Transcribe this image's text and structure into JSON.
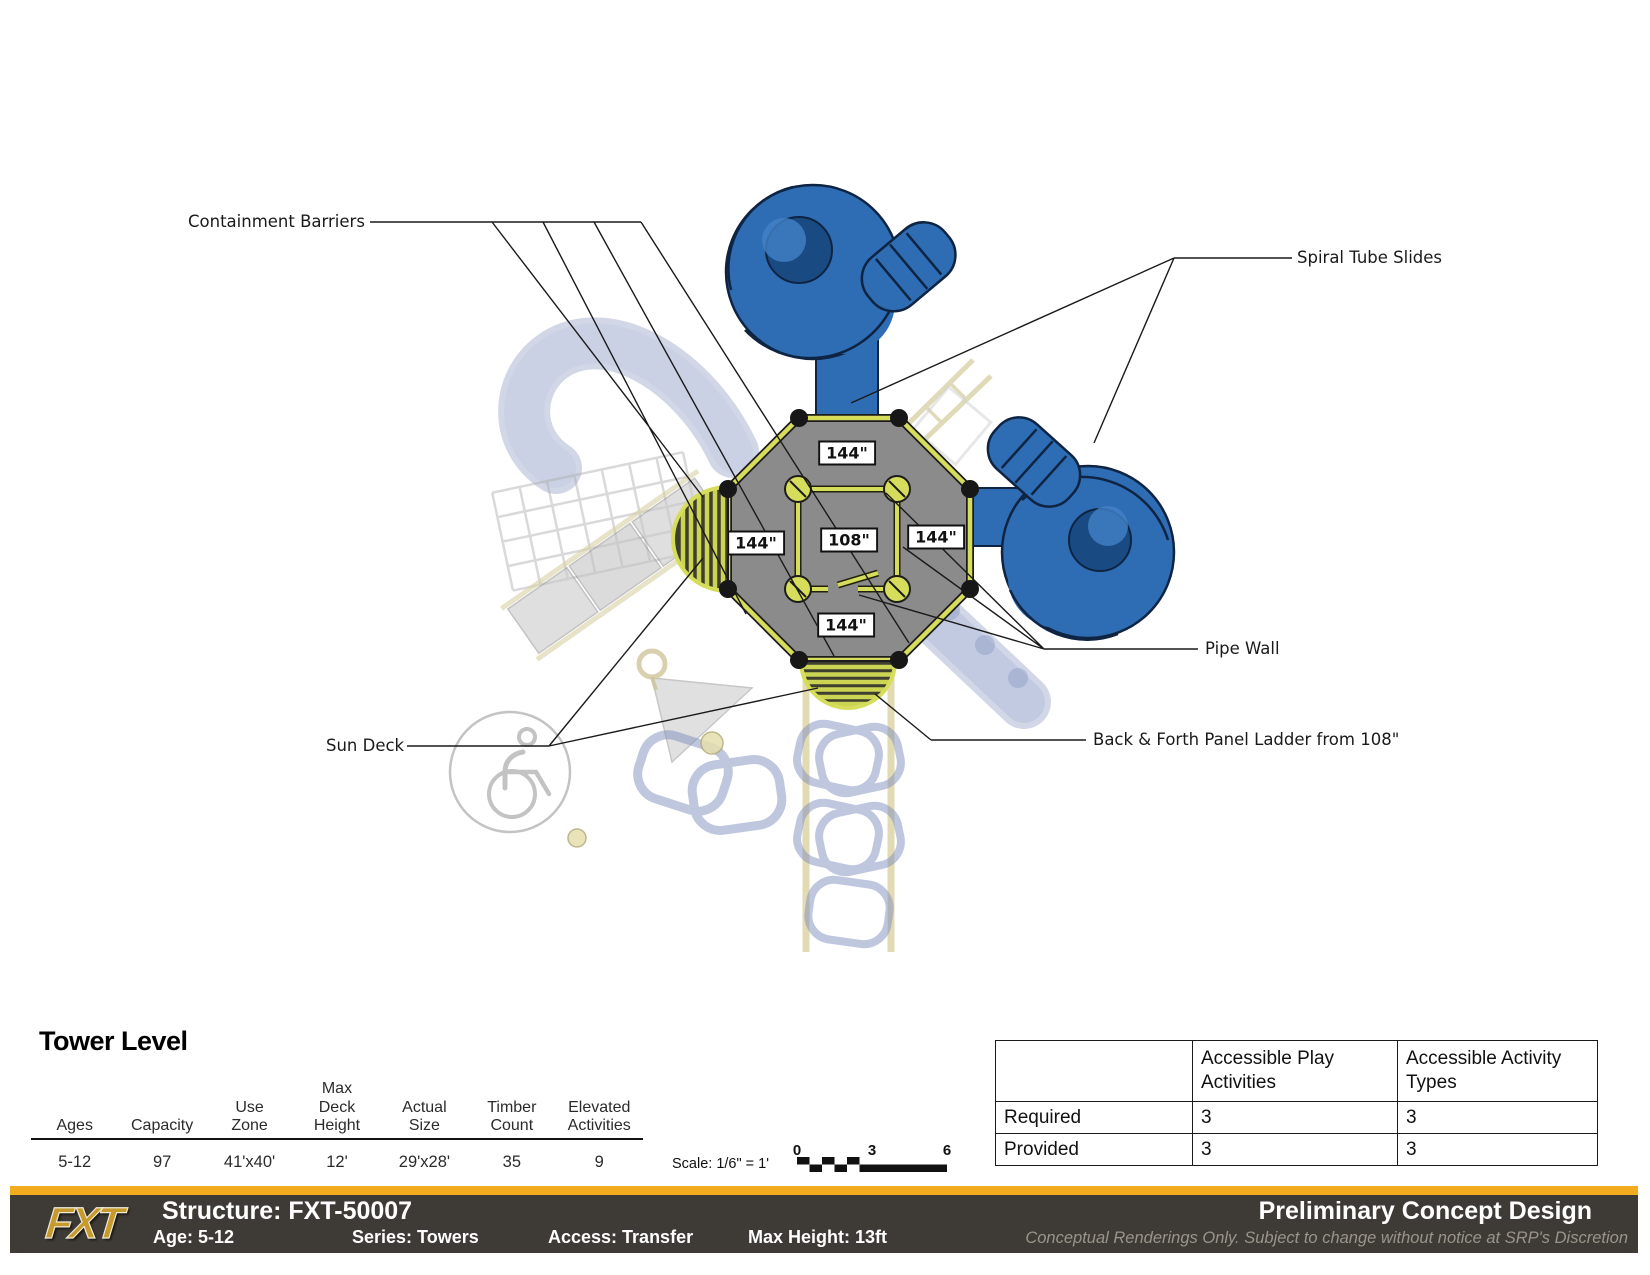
{
  "colors": {
    "accent_yellow": "#F2AC1E",
    "footer_bg": "#3E3A35",
    "slide_blue": "#2E6CB4",
    "deck_gray": "#8B8B8B",
    "rail_yellow": "#D6DD5A"
  },
  "diagram": {
    "callouts": {
      "containment_barriers": "Containment Barriers",
      "spiral_tube_slides": "Spiral Tube Slides",
      "pipe_wall": "Pipe Wall",
      "sun_deck": "Sun Deck",
      "panel_ladder": "Back & Forth Panel Ladder from 108\""
    },
    "deck_dimensions": {
      "top": "144\"",
      "left": "144\"",
      "center": "108\"",
      "right": "144\"",
      "bottom": "144\""
    }
  },
  "tower_level": {
    "title": "Tower Level",
    "columns": [
      {
        "header": "Ages",
        "value": "5-12"
      },
      {
        "header": "Capacity",
        "value": "97"
      },
      {
        "header": "Use\nZone",
        "value": "41'x40'"
      },
      {
        "header": "Max\nDeck\nHeight",
        "value": "12'"
      },
      {
        "header": "Actual\nSize",
        "value": "29'x28'"
      },
      {
        "header": "Timber\nCount",
        "value": "35"
      },
      {
        "header": "Elevated\nActivities",
        "value": "9"
      }
    ]
  },
  "scale": {
    "label": "Scale: 1/6\" = 1'",
    "ticks": [
      "0",
      "3",
      "6"
    ]
  },
  "accessibility_table": {
    "headers": [
      "",
      "Accessible Play\nActivities",
      "Accessible Activity\nTypes"
    ],
    "rows": [
      {
        "label": "Required",
        "values": [
          "3",
          "3"
        ]
      },
      {
        "label": "Provided",
        "values": [
          "3",
          "3"
        ]
      }
    ]
  },
  "footer": {
    "logo": "FXT",
    "structure": "Structure: FXT-50007",
    "age": "Age: 5-12",
    "series": "Series: Towers",
    "access": "Access: Transfer",
    "max_height": "Max Height: 13ft",
    "design_title": "Preliminary Concept Design",
    "disclaimer": "Conceptual Renderings Only. Subject to change without notice at SRP's Discretion"
  }
}
